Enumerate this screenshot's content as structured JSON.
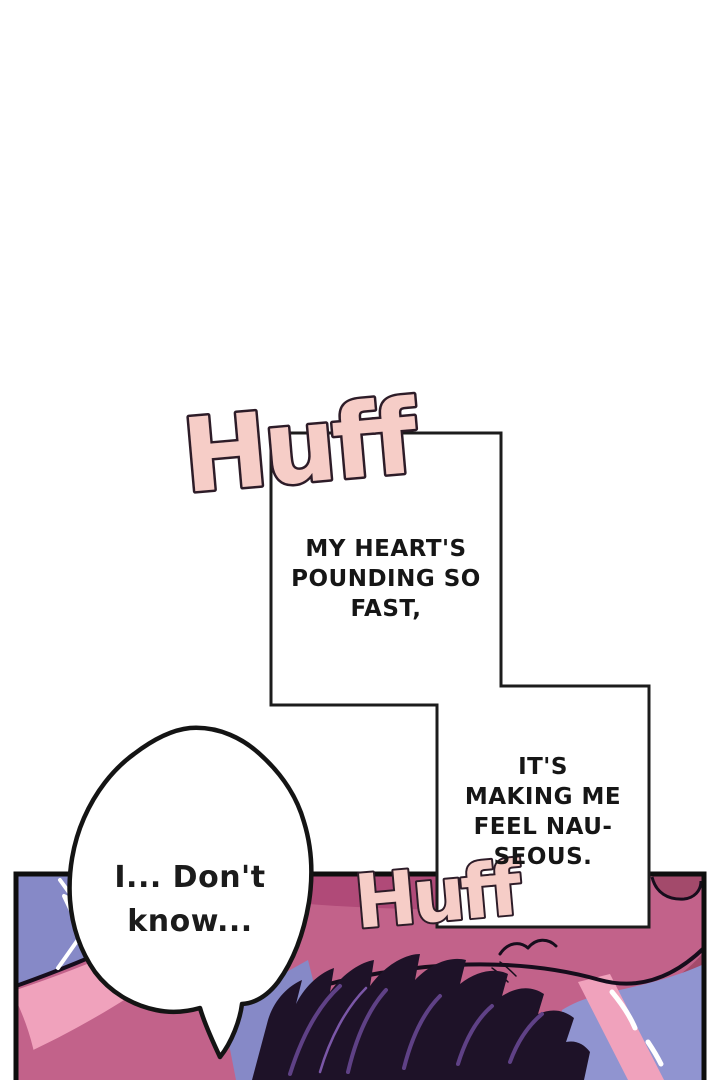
{
  "page": {
    "kind": "webtoon-episode-panel"
  },
  "sfx": {
    "huff_top": {
      "text": "Huff"
    },
    "huff_bottom": {
      "text": "Huff"
    }
  },
  "captions": {
    "box1": {
      "lines": [
        "MY HEART'S",
        "POUNDING SO",
        "FAST,"
      ]
    },
    "box2": {
      "lines": [
        "IT'S",
        "MAKING ME",
        "FEEL NAU-",
        "SEOUS."
      ]
    }
  },
  "speech": {
    "bubble": {
      "lines": [
        "I... Don't",
        "know..."
      ]
    }
  },
  "colors": {
    "paper": "#ffffff",
    "sfx_fill": "#f6cdc7",
    "sfx_outline": "#2d1c28",
    "caption_text": "#161616",
    "box_fill": "#ffffff",
    "box_border": "#1c1c1c",
    "panel_border": "#0e0e0e",
    "ink": "#160d1c",
    "periwinkle": "#8689c7",
    "periwinkle_light": "#9094d0",
    "pink_mid": "#c2628a",
    "pink_deepband": "#b04a78",
    "pink_light": "#f0a2bc",
    "mauve_deep": "#a34a6b",
    "hair_dark": "#1e1228",
    "hair_purple": "#5f4186",
    "hair_purple_light": "#7b57a8",
    "shine_white": "#ffffff"
  }
}
